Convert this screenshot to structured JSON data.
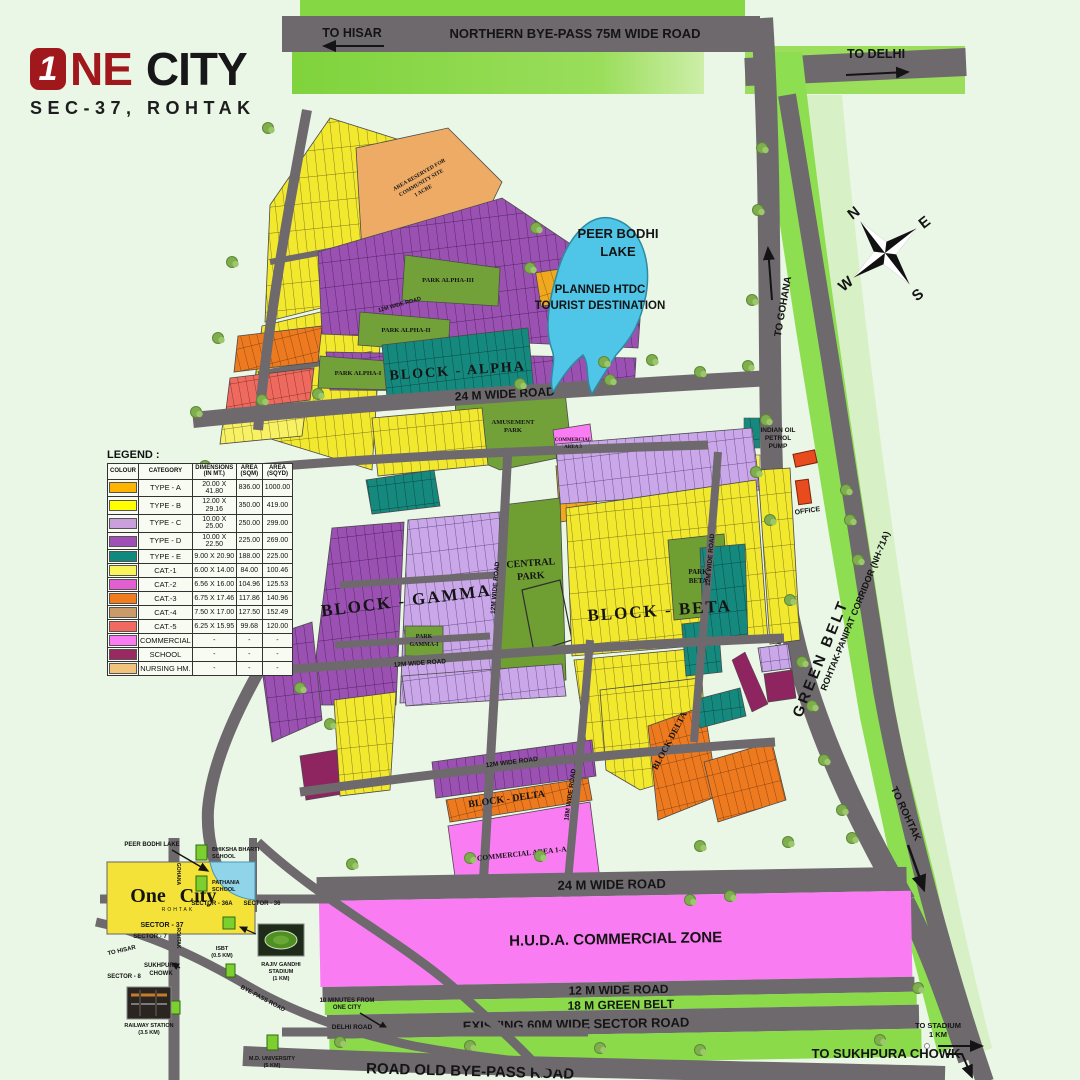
{
  "brand": {
    "numeral": "1",
    "one_rest": "NE",
    "city": "CITY",
    "subtitle": "SEC-37, ROHTAK"
  },
  "legend": {
    "title": "LEGEND :",
    "headers": [
      "COLOUR",
      "CATEGORY",
      "DIMENSIONS (IN MT.)",
      "AREA (SQM)",
      "AREA (SQYD)"
    ],
    "rows": [
      {
        "color": "#FFB400",
        "category": "TYPE - A",
        "dimensions": "20.00 X 41.80",
        "area_sqm": "836.00",
        "area_sqyd": "1000.00"
      },
      {
        "color": "#FFFF00",
        "category": "TYPE - B",
        "dimensions": "12.00 X 29.16",
        "area_sqm": "350.00",
        "area_sqyd": "419.00"
      },
      {
        "color": "#C9A0DC",
        "category": "TYPE - C",
        "dimensions": "10.00 X 25.00",
        "area_sqm": "250.00",
        "area_sqyd": "299.00"
      },
      {
        "color": "#9F4FB5",
        "category": "TYPE - D",
        "dimensions": "10.00 X 22.50",
        "area_sqm": "225.00",
        "area_sqyd": "269.00"
      },
      {
        "color": "#108A7E",
        "category": "TYPE - E",
        "dimensions": "9.00 X 20.90",
        "area_sqm": "188.00",
        "area_sqyd": "225.00"
      },
      {
        "color": "#FAF45C",
        "category": "CAT.-1",
        "dimensions": "6.00 X 14.00",
        "area_sqm": "84.00",
        "area_sqyd": "100.46"
      },
      {
        "color": "#E25FD2",
        "category": "CAT.-2",
        "dimensions": "6.56 X 16.00",
        "area_sqm": "104.96",
        "area_sqyd": "125.53"
      },
      {
        "color": "#F07C1E",
        "category": "CAT.-3",
        "dimensions": "6.75 X 17.46",
        "area_sqm": "117.86",
        "area_sqyd": "140.96"
      },
      {
        "color": "#C89B68",
        "category": "CAT.-4",
        "dimensions": "7.50 X 17.00",
        "area_sqm": "127.50",
        "area_sqyd": "152.49"
      },
      {
        "color": "#F2695F",
        "category": "CAT.-5",
        "dimensions": "6.25 X 15.95",
        "area_sqm": "99.68",
        "area_sqyd": "120.00"
      },
      {
        "color": "#FB7CF2",
        "category": "COMMERCIAL",
        "dimensions": "-",
        "area_sqm": "-",
        "area_sqyd": "-"
      },
      {
        "color": "#992960",
        "category": "SCHOOL",
        "dimensions": "-",
        "area_sqm": "-",
        "area_sqyd": "-"
      },
      {
        "color": "#F3C27D",
        "category": "NURSING HM.",
        "dimensions": "-",
        "area_sqm": "-",
        "area_sqyd": "-"
      }
    ]
  },
  "roads": {
    "northern_bypass": "NORTHERN BYE-PASS 75M WIDE ROAD",
    "to_hisar": "TO HISAR",
    "to_delhi": "TO DELHI",
    "to_gohana": "TO GOHANA",
    "to_rohtak": "TO ROHTAK",
    "to_stadium_l1": "TO STADIUM",
    "to_stadium_l2": "1 KM",
    "to_sukhpura": "TO SUKHPURA CHOWK",
    "r24": "24 M WIDE ROAD",
    "r12": "12 M WIDE ROAD",
    "r12s": "12M WIDE ROAD",
    "r18s": "18M WIDE ROAD",
    "green18": "18 M GREEN BELT",
    "sector60": "EXISTING 60M WIDE SECTOR ROAD",
    "old_bypass": "ROAD OLD BYE-PASS ROAD",
    "corridor": "ROHTAK-PANIPAT CORRIDOR (NH-71A)",
    "green_belt": "GREEN BELT"
  },
  "areas": {
    "huda": "H.U.D.A. COMMERCIAL ZONE",
    "block_alpha": "BLOCK - ALPHA",
    "block_beta": "BLOCK - BETA",
    "block_gamma": "BLOCK - GAMMA",
    "block_delta": "BLOCK - DELTA",
    "block_delta_short": "BLOCK DELTA",
    "central_l1": "CENTRAL",
    "central_l2": "PARK",
    "parkbeta_l1": "PARK",
    "parkbeta_l2": "BETA",
    "parkgamma_l1": "PARK",
    "parkgamma_l2": "GAMMA-I",
    "park_alpha1": "PARK ALPHA-I",
    "park_alpha2": "PARK ALPHA-II",
    "park_alpha3": "PARK ALPHA-III",
    "amusement_l1": "AMUSEMENT",
    "amusement_l2": "PARK",
    "comm3_l1": "COMMERCIAL",
    "comm3_l2": "AREA 3",
    "comm1a": "COMMERCIAL AREA 1-A",
    "community_l1": "AREA RESERVED FOR",
    "community_l2": "COMMUNITY SITE",
    "community_l3": "1 ACRE"
  },
  "lake": {
    "l1": "PEER BODHI",
    "l2": "LAKE",
    "p1": "PLANNED HTDC",
    "p2": "TOURIST DESTINATION"
  },
  "poi": {
    "petrol_l1": "INDIAN OIL",
    "petrol_l2": "PETROL",
    "petrol_l3": "PUMP",
    "site_office": "SITE OFFICE",
    "note_l1": "10 MINUTES FROM",
    "note_l2": "ONE CITY"
  },
  "compass": {
    "n": "N",
    "e": "E",
    "s": "S",
    "w": "W"
  },
  "inset": {
    "one_city_1": "One",
    "one_city_2": "City",
    "rohtak_small": "ROHTAK",
    "sector37": "SECTOR - 37",
    "peer_lake": "PEER BODHI LAKE",
    "school1_l1": "BHIKSHA BHARTI",
    "school1_l2": "SCHOOL",
    "school2_l1": "PATHANIA",
    "school2_l2": "SCHOOL",
    "sector36a": "SECTOR - 36A",
    "sector36": "SECTOR - 36",
    "sector7": "SECTOR - 7",
    "sector8": "SECTOR - 8",
    "chowk_l1": "SUKHPURA",
    "chowk_l2": "CHOWK",
    "to_hisar": "TO HISAR",
    "isbt_l1": "ISBT",
    "isbt_l2": "(0.5 KM)",
    "stadium_l1": "RAJIV GANDHI",
    "stadium_l2": "STADIUM",
    "stadium_l3": "(1 KM)",
    "railway_l1": "RAILWAY STATION",
    "railway_l2": "(3.5 KM)",
    "univ_l1": "M.D. UNIVERSITY",
    "univ_l2": "(5 KM)",
    "delhi_road": "DELHI ROAD",
    "bypass_road": "BYE-PASS ROAD",
    "gohana": "GOHANA",
    "rohtak_v": "ROHTAK"
  }
}
